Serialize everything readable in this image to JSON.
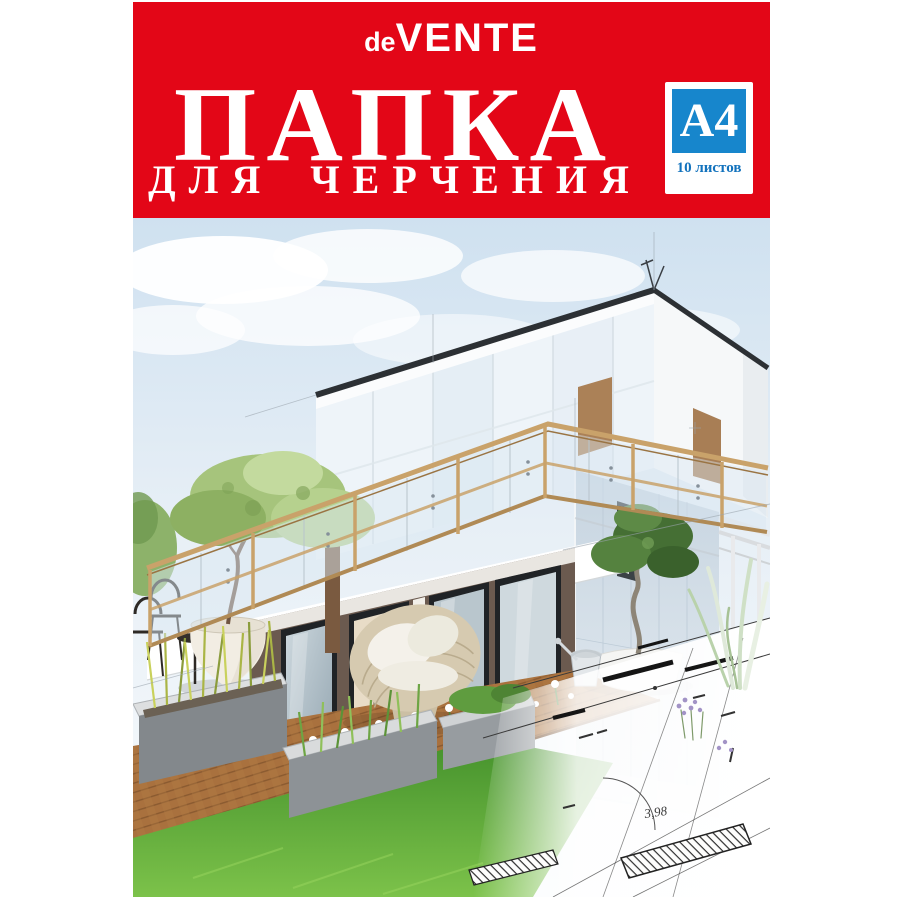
{
  "cover": {
    "brand": {
      "prefix": "de",
      "name": "VENTE"
    },
    "title_line1": "ПАПКА",
    "title_line2": "ДЛЯ ЧЕРЧЕНИЯ",
    "badge": {
      "format": "A4",
      "sheets": "10 листов"
    },
    "colors": {
      "header_red": "#e30617",
      "badge_blue": "#1786cc",
      "badge_text_blue": "#1272bd",
      "sky_blue": "#cfe1f0",
      "grass_green": "#5aa33a",
      "deck_brown": "#a9713f",
      "wood_rail": "#c9a26a"
    },
    "illustration": {
      "dimension_label": "3,98"
    }
  }
}
